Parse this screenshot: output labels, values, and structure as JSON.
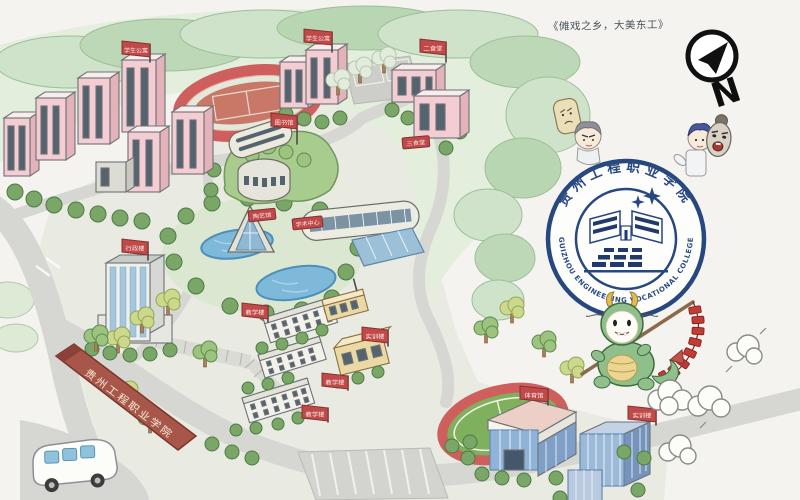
{
  "annotation": {
    "quote": "《傩戏之乡，大美东工》"
  },
  "compass": {
    "label": "N"
  },
  "logo": {
    "name_cn": "贵州工程职业学院",
    "name_en": "GUIZHOU ENGINEERING VOCATIONAL COLLEGE"
  },
  "gate": {
    "wall_text": "贵州工程职业学院"
  },
  "map": {
    "flags": [
      {
        "id": "dorm-nw",
        "label": "学生公寓"
      },
      {
        "id": "dorm-n",
        "label": "学生公寓"
      },
      {
        "id": "canteen-2",
        "label": "二食堂"
      },
      {
        "id": "library",
        "label": "图书馆"
      },
      {
        "id": "admin",
        "label": "行政楼"
      },
      {
        "id": "teach-1",
        "label": "教学楼"
      },
      {
        "id": "training-1",
        "label": "实训楼"
      },
      {
        "id": "teach-2",
        "label": "教学楼"
      },
      {
        "id": "teach-3",
        "label": "教学楼"
      },
      {
        "id": "gym",
        "label": "体育馆"
      },
      {
        "id": "training-2",
        "label": "实训楼"
      }
    ],
    "signs": [
      {
        "id": "pottery",
        "label": "陶艺馆"
      },
      {
        "id": "academic",
        "label": "学术中心"
      },
      {
        "id": "canteen-3",
        "label": "三食堂"
      }
    ]
  },
  "colors": {
    "flag_red": "#c04a4a",
    "logo_navy": "#27477f",
    "pond_blue": "#7fb9da",
    "track_red": "#cf5f5c",
    "hill_green": "#bdd8b6",
    "wall_red": "#a9564a"
  }
}
